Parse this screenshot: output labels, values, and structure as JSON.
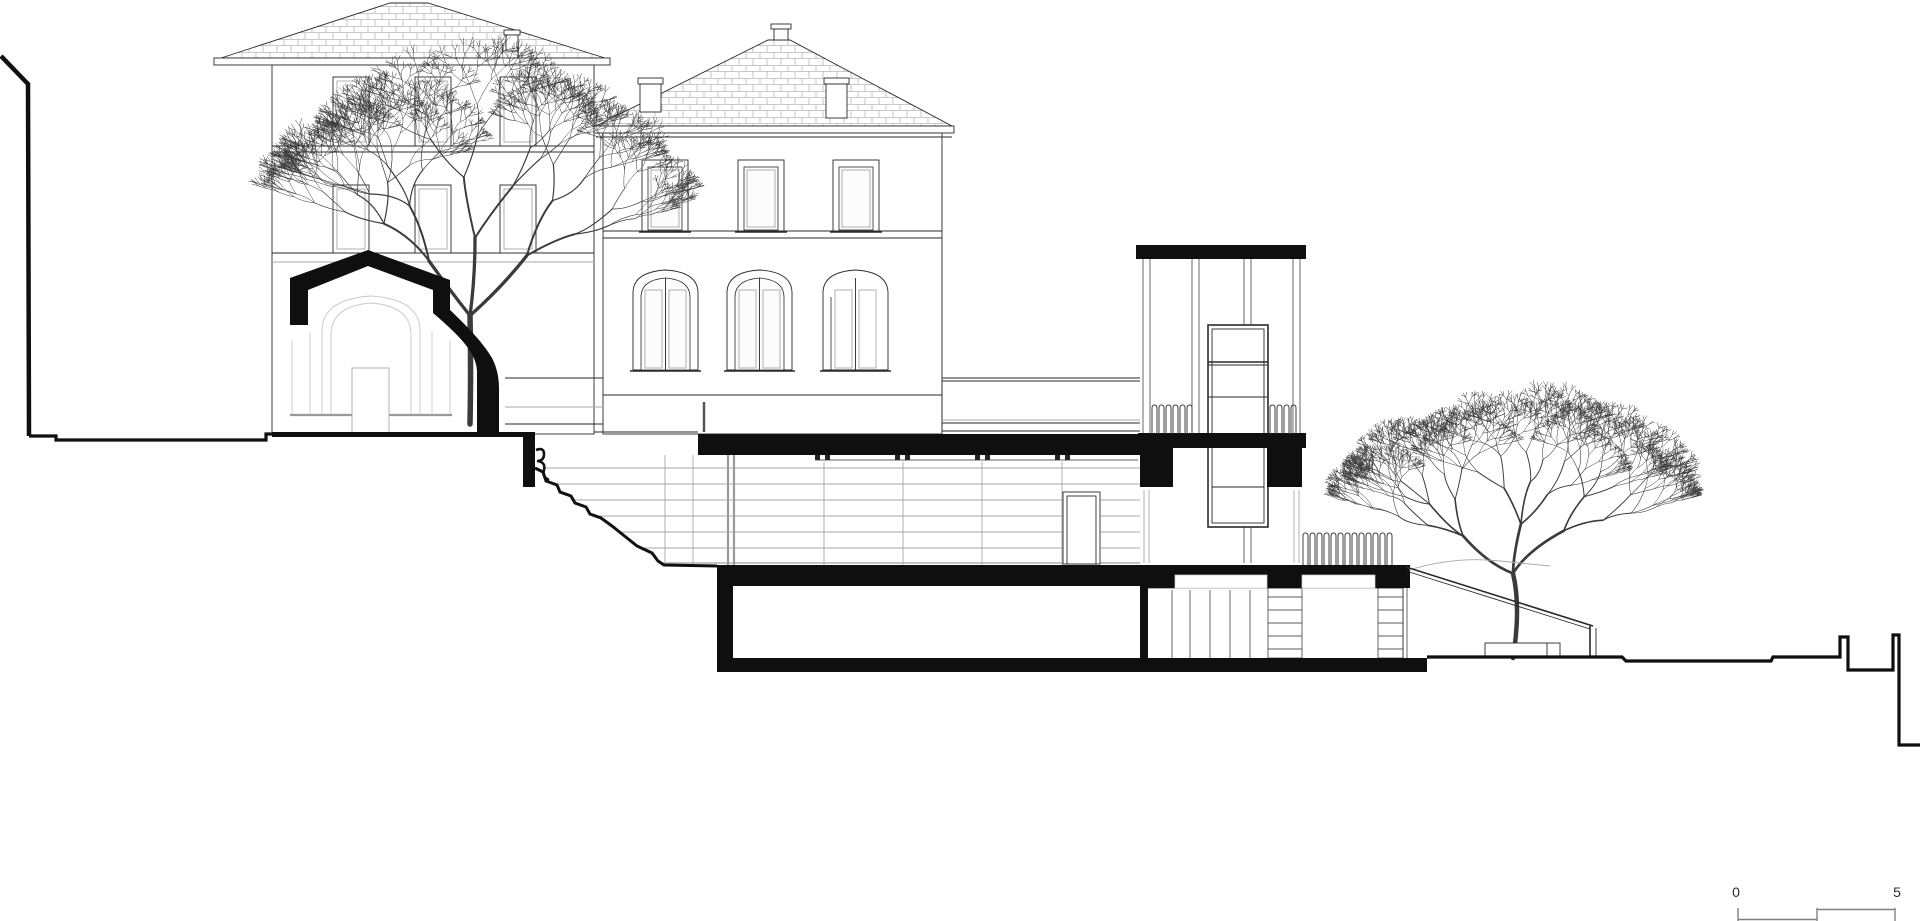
{
  "drawing": {
    "kind": "architectural-site-section",
    "scale_bar": {
      "start_label": "0",
      "end_label": "5"
    },
    "palette": {
      "ink": "#2a2a2a",
      "poche": "#0f0f0f",
      "mid": "#777777",
      "light": "#a8a8a8",
      "faint": "#c9c9c9",
      "background": "#ffffff"
    }
  }
}
